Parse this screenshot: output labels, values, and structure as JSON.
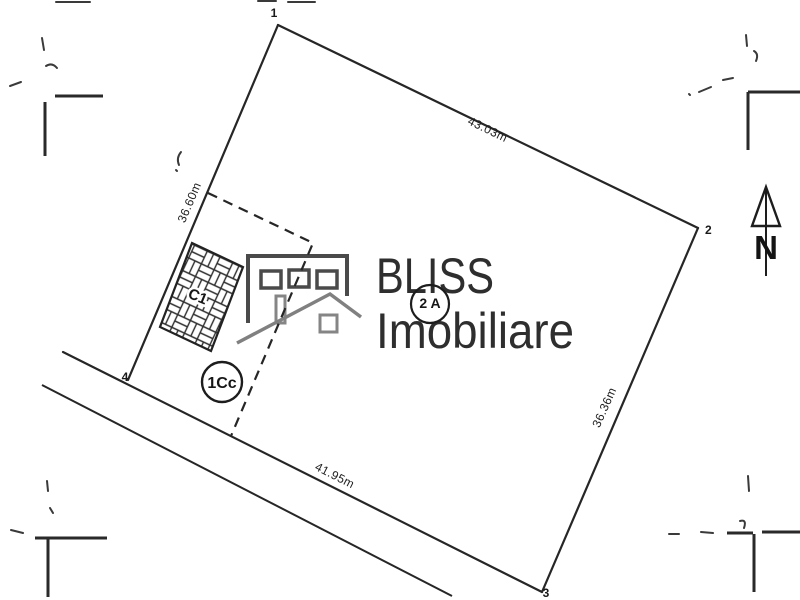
{
  "plan": {
    "corners": {
      "p1": "1",
      "p2": "2",
      "p3": "3",
      "p4": "4"
    },
    "dimensions": {
      "top": "43.03m",
      "right": "36.36m",
      "bottom": "41.95m",
      "left": "36.60m"
    },
    "building_label": "C1",
    "zones": {
      "courtyard": "1Cc",
      "parcel_unit": "2 A"
    },
    "north_label": "N"
  },
  "watermark": {
    "brand": "BLISS",
    "brand_sub": "Imobiliare"
  },
  "colors": {
    "drawing_line": "#262626",
    "logo_dark": "#4a4a4a",
    "logo_light": "#858585",
    "brand_text": "#2e2e2e",
    "paper": "#ffffff"
  }
}
